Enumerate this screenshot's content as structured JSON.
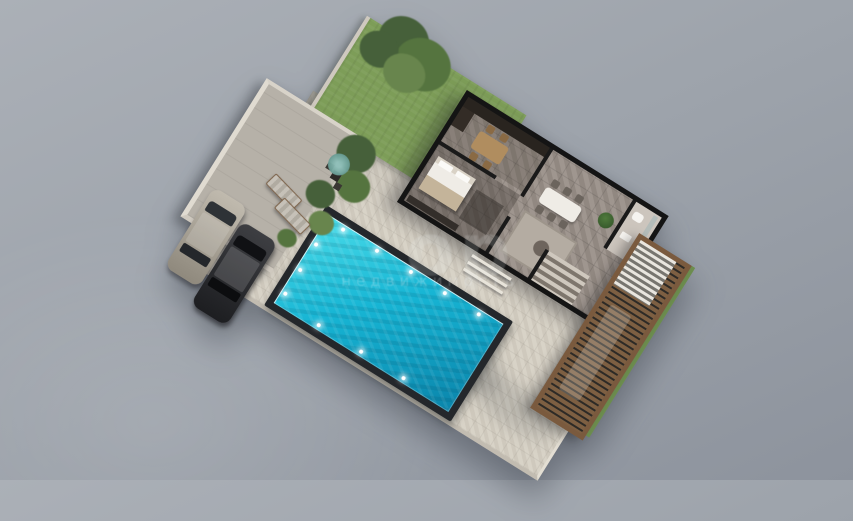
{
  "image": {
    "type": "3d-floor-plan-render",
    "view": "isometric top-down",
    "subject": "Single-storey villa plot with swimming pool, lawn, carport, stone terrace and louvered pergola",
    "background": "plain gray studio backdrop"
  },
  "watermark": {
    "large_text": "ор",
    "small_text": "недвижимость"
  },
  "scene": {
    "areas": [
      {
        "name": "garden-lawn",
        "color": "#7d9d58"
      },
      {
        "name": "stone-terrace",
        "color": "#d6d0c4"
      },
      {
        "name": "carport-driveway",
        "color": "#b6b1a8"
      },
      {
        "name": "swimming-pool",
        "water_color": "#17b5d4",
        "rim_color": "#24272b"
      },
      {
        "name": "pergola-deck",
        "wood_color": "#7a5a3e"
      },
      {
        "name": "villa-house",
        "wall_color": "#141414"
      }
    ],
    "objects": [
      "large garden tree on lawn",
      "olive trees beside driveway",
      "silver car in carport",
      "dark gray car in carport",
      "two sun loungers by pool",
      "bistro table with two chairs and teal umbrella",
      "kitchen with dark counter and wooden dining table",
      "bedroom with double bed and wardrobe",
      "living room rug with round coffee tables",
      "white dining table with six chairs",
      "indoor plant",
      "bathroom with toilet, sink and shower",
      "interior staircase",
      "outdoor terrace steps",
      "pool underwater lights"
    ]
  },
  "palette": {
    "bg1": "#abb0b7",
    "bg2": "#9da3ab",
    "bg3": "#8d939d",
    "lawn": "#7d9d58",
    "grass2": "#6d8e4f",
    "terrace": "#d6d0c4",
    "drive": "#b6b1a8",
    "wall": "#141414",
    "floor": "#9a9089",
    "white": "#efece6",
    "woodlite": "#b08d5f",
    "pool-rim": "#24272b",
    "pool1": "#4adce9",
    "pool2": "#17b5d4",
    "pool3": "#0a85ab",
    "wood": "#7d5f42",
    "wood-dark": "#2d2a26",
    "frame": "#7a5a3e",
    "tree1": "#55743f",
    "tree2": "#68854d",
    "tree3": "#46603a",
    "umbrella": "#6fa39b"
  }
}
